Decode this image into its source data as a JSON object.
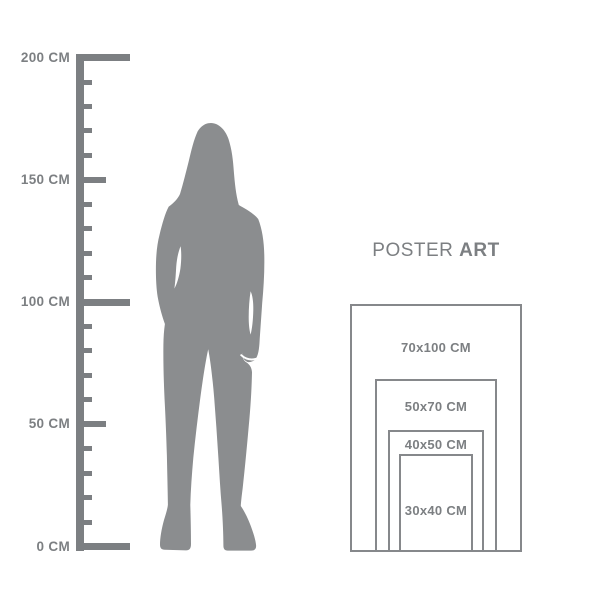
{
  "colors": {
    "ruler": "#7c7f82",
    "label_text": "#7c7f82",
    "silhouette": "#8b8d8f",
    "poster_border": "#86888b",
    "background": "#ffffff"
  },
  "ruler": {
    "unit": "CM",
    "min_cm": 0,
    "max_cm": 200,
    "labeled_step_cm": 50,
    "minor_step_cm": 10,
    "labels": [
      {
        "cm": 200,
        "text": "200 CM"
      },
      {
        "cm": 150,
        "text": "150 CM"
      },
      {
        "cm": 100,
        "text": "100 CM"
      },
      {
        "cm": 50,
        "text": "50 CM"
      },
      {
        "cm": 0,
        "text": "0 CM"
      }
    ]
  },
  "figure": {
    "description": "gray silhouette of a standing woman with long hair, arms at sides"
  },
  "poster": {
    "heading": {
      "regular": "POSTER",
      "bold": "ART"
    },
    "sizes": [
      {
        "label": "70x100 CM",
        "width_cm": 70,
        "height_cm": 100
      },
      {
        "label": "50x70 CM",
        "width_cm": 50,
        "height_cm": 70
      },
      {
        "label": "40x50 CM",
        "width_cm": 40,
        "height_cm": 50
      },
      {
        "label": "30x40 CM",
        "width_cm": 30,
        "height_cm": 40
      }
    ]
  }
}
